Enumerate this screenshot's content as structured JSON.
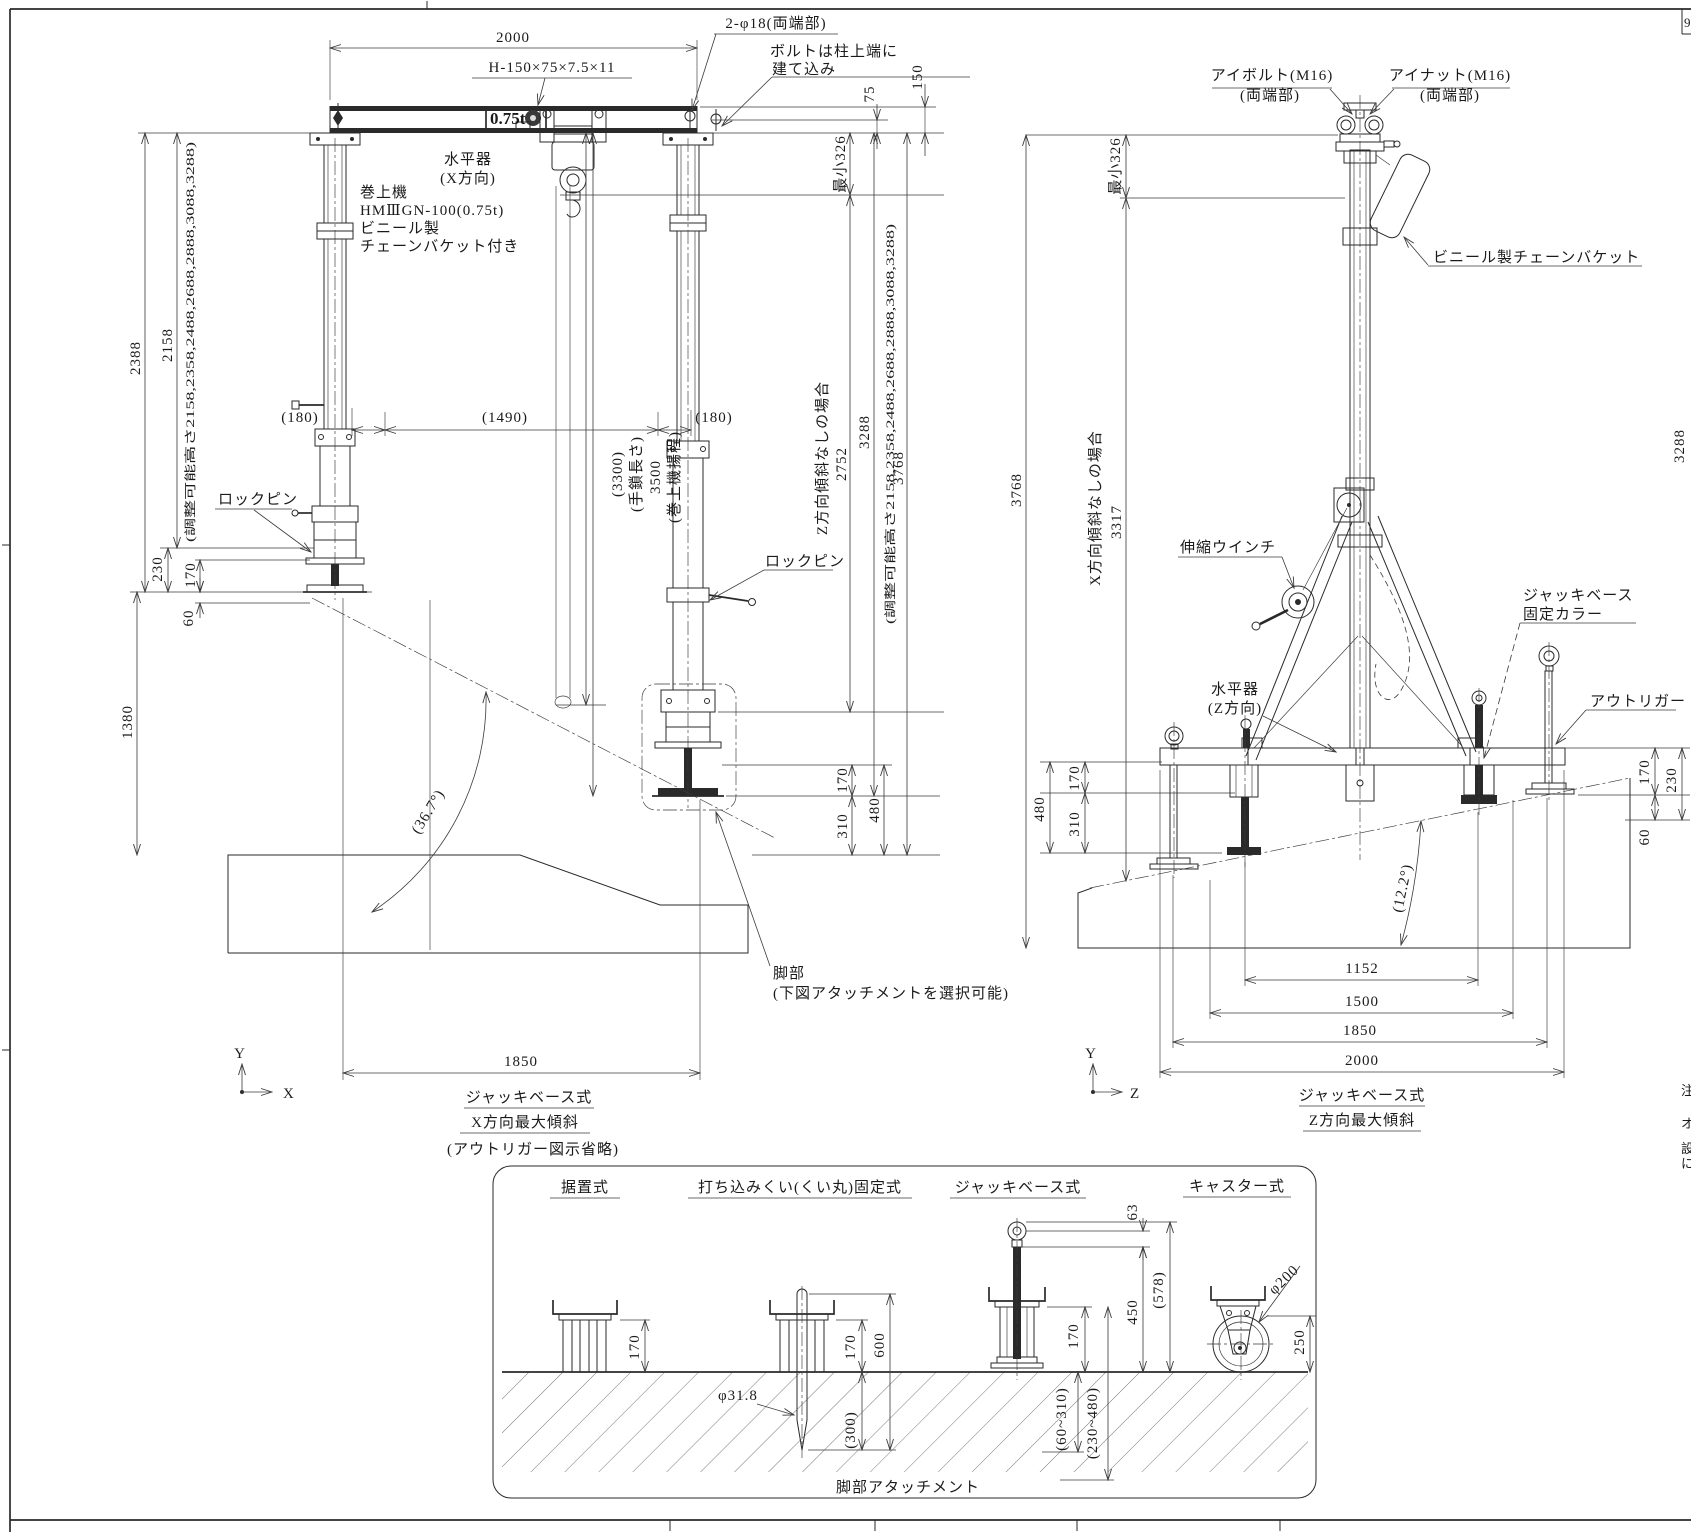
{
  "sheet": {
    "corner_mark": "9",
    "edge_notes": {
      "n1": "注",
      "n2": "オ",
      "n3": "設",
      "n4": "に"
    }
  },
  "left": {
    "d2000": "2000",
    "beam_spec": "H-150×75×7.5×11",
    "holes": "2-φ18(両端部)",
    "bolt_note1": "ボルトは柱上端に",
    "bolt_note2": "建て込み",
    "d150": "150",
    "d75": "75",
    "min326": "最小326",
    "capacity": "0.75t",
    "level1": "水平器",
    "level2": "(X方向)",
    "hoist1": "巻上機",
    "hoist2": "HMⅢGN-100(0.75t)",
    "hoist3": "ビニール製",
    "hoist4": "チェーンバケット付き",
    "h2388": "2388",
    "h2158": "2158",
    "adj_heights": "(調整可能高さ2158,2358,2488,2688,2888,3088,3288)",
    "d180l": "(180)",
    "d1490": "(1490)",
    "d180r": "(180)",
    "chain_len": "(3300)",
    "chain_label": "(手鎖長さ)",
    "lift": "3500",
    "lift_label": "(巻上機揚程)",
    "no_tilt_z": "Z方向傾斜なしの場合",
    "h2752": "2752",
    "h3288": "3288",
    "h3768": "3768",
    "lockpin": "ロックピン",
    "d230": "230",
    "d170": "170",
    "d60": "60",
    "h1380": "1380",
    "angle": "(36.7°)",
    "d170b": "170",
    "d310": "310",
    "d480": "480",
    "w1850": "1850",
    "leg1": "脚部",
    "leg2": "(下図アタッチメントを選択可能)",
    "axis_v": "Y",
    "axis_h": "X",
    "cap1": "ジャッキベース式",
    "cap2": "X方向最大傾斜",
    "cap3": "(アウトリガー図示省略)"
  },
  "right": {
    "eyebolt": "アイボルト(M16)",
    "eyebolt2": "(両端部)",
    "eyenut": "アイナット(M16)",
    "eyenut2": "(両端部)",
    "bucket": "ビニール製チェーンバケット",
    "min326": "最小326",
    "h3768": "3768",
    "no_tilt_x": "X方向傾斜なしの場合",
    "h3317": "3317",
    "winch": "伸縮ウインチ",
    "collar1": "ジャッキベース",
    "collar2": "固定カラー",
    "level1": "水平器",
    "level2": "(Z方向)",
    "outrigger": "アウトリガー",
    "d480": "480",
    "d170l": "170",
    "d310": "310",
    "d170r": "170",
    "d230": "230",
    "d60": "60",
    "angle": "(12.2°)",
    "w1152": "1152",
    "w1500": "1500",
    "w1850": "1850",
    "w2000": "2000",
    "edge3288": "3288",
    "axis_v": "Y",
    "axis_h": "Z",
    "cap1": "ジャッキベース式",
    "cap2": "Z方向最大傾斜"
  },
  "attach": {
    "t1": "据置式",
    "t2": "打ち込みくい(くい丸)固定式",
    "t3": "ジャッキベース式",
    "t4": "キャスター式",
    "a1_170": "170",
    "pile_dia": "φ31.8",
    "a2_300": "(300)",
    "a2_170": "170",
    "a2_600": "600",
    "a3_63": "63",
    "a3_450": "450",
    "a3_578": "(578)",
    "a3_170": "170",
    "a3_r1": "(60~310)",
    "a3_r2": "(230~480)",
    "a4_dia": "φ200",
    "a4_250": "250",
    "caption": "脚部アタッチメント"
  }
}
